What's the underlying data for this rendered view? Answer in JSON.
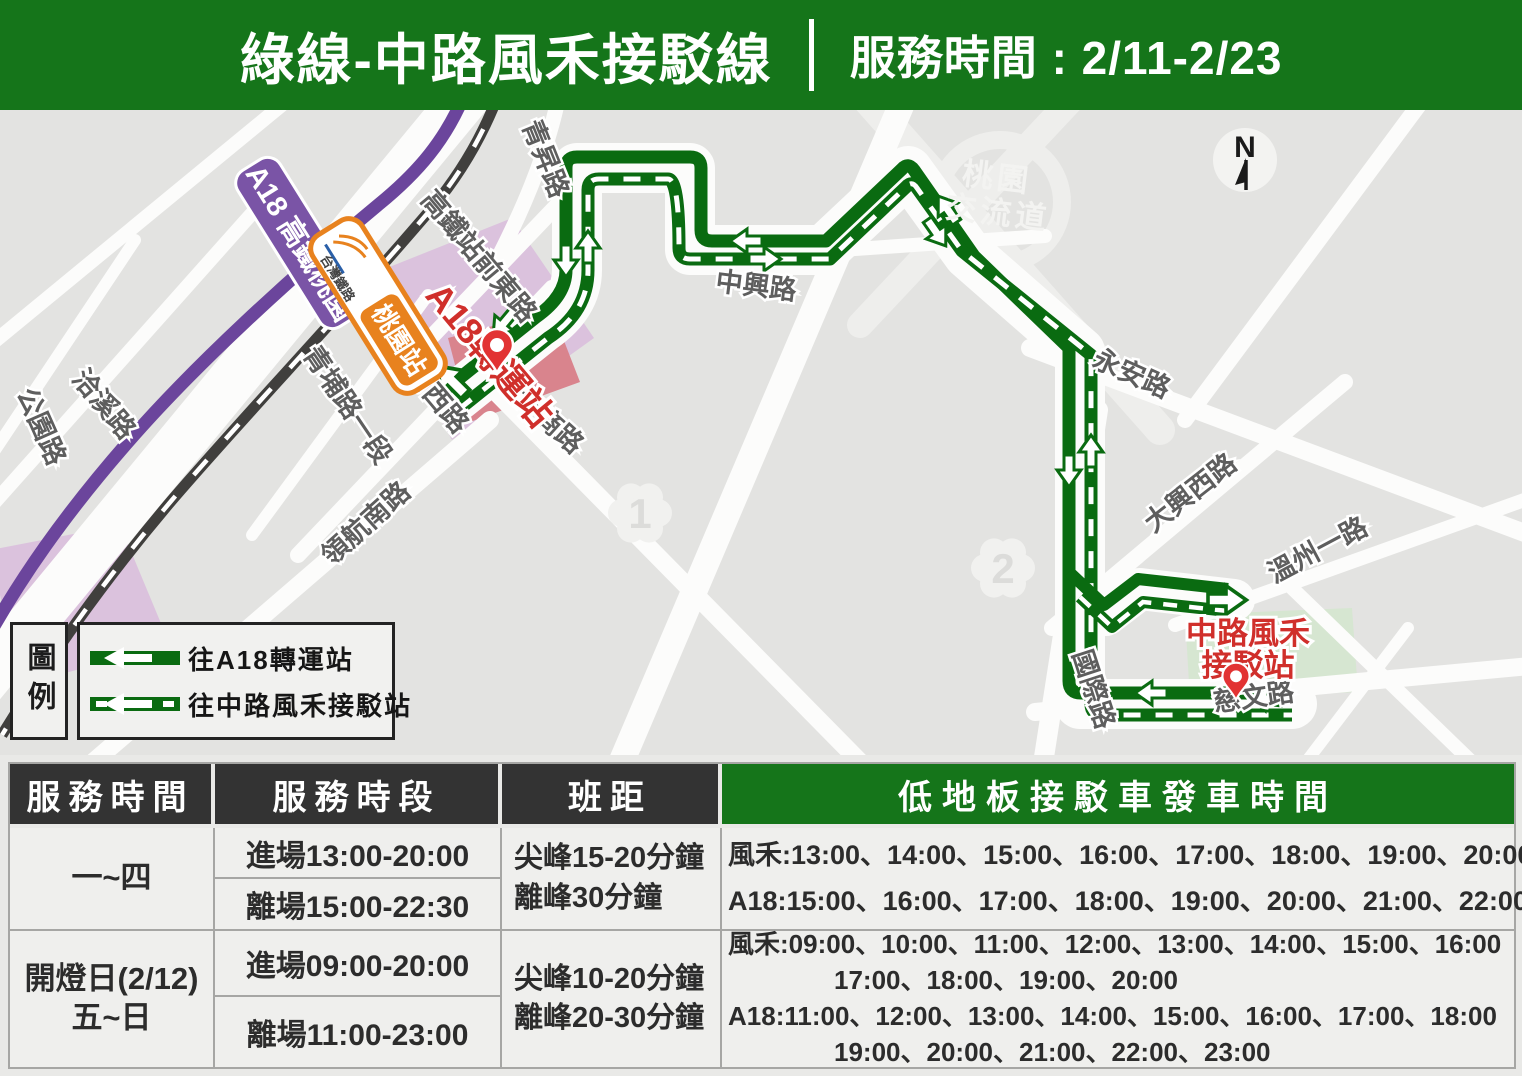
{
  "colors": {
    "brand_green": "#15751a",
    "route_green": "#0a6b11",
    "station_red": "#d02f2b",
    "metro_purple": "#7a54a6",
    "tra_orange": "#e8821e",
    "table_header_dark": "#333333"
  },
  "header": {
    "title": "綠線-中路風禾接駁線",
    "service": "服務時間 : 2/11-2/23"
  },
  "map": {
    "compass": "N",
    "interchange_line1": "桃園",
    "interchange_line2": "交流道",
    "flowers": [
      {
        "n": "1"
      },
      {
        "n": "2"
      }
    ],
    "road_labels": [
      "青昇路",
      "高鐵站前東路",
      "高鐵站前西路",
      "青埔路一段",
      "公園路",
      "洽溪路",
      "領航南路",
      "青商路",
      "中興路",
      "永安路",
      "大興西路",
      "溫州一路",
      "國際路",
      "慈文路"
    ],
    "badges": {
      "metro_line": "A18",
      "metro_name": "高鐵桃園",
      "tra_operator": "台灣鐵路",
      "tra_station": "桃園站"
    },
    "stations": {
      "a18": "A18轉運站",
      "fenghe_line1": "中路風禾",
      "fenghe_line2": "接駁站"
    }
  },
  "legend": {
    "title": "圖例",
    "items": [
      {
        "label": "往A18轉運站"
      },
      {
        "label": "往中路風禾接駁站"
      }
    ]
  },
  "table": {
    "headers": [
      "服務時間",
      "服務時段",
      "班距",
      "低地板接駁車發車時間"
    ],
    "rows": [
      {
        "period": "一~四",
        "period2": "",
        "sessions": [
          "進場13:00-20:00",
          "離場15:00-22:30"
        ],
        "headway": [
          "尖峰15-20分鐘",
          "離峰30分鐘"
        ],
        "departures": [
          "風禾:13:00、14:00、15:00、16:00、17:00、18:00、19:00、20:00",
          "A18:15:00、16:00、17:00、18:00、19:00、20:00、21:00、22:00"
        ]
      },
      {
        "period": "開燈日(2/12)",
        "period2": "五~日",
        "sessions": [
          "進場09:00-20:00",
          "離場11:00-23:00"
        ],
        "headway": [
          "尖峰10-20分鐘",
          "離峰20-30分鐘"
        ],
        "departures": [
          "風禾:09:00、10:00、11:00、12:00、13:00、14:00、15:00、16:00",
          "17:00、18:00、19:00、20:00",
          "A18:11:00、12:00、13:00、14:00、15:00、16:00、17:00、18:00",
          "19:00、20:00、21:00、22:00、23:00"
        ]
      }
    ]
  }
}
